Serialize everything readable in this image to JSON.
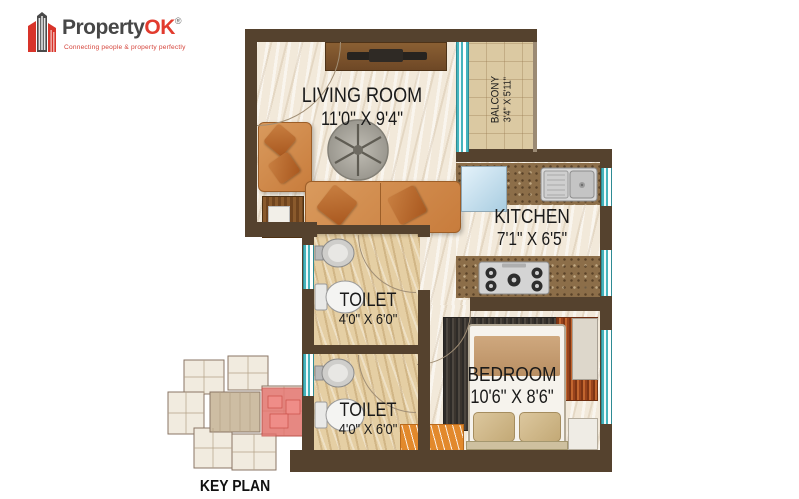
{
  "logo": {
    "brand": "Property",
    "brand_accent": "OK",
    "registered": "®",
    "tagline": "Connecting people & property perfectly"
  },
  "plan": {
    "living_room": {
      "name": "LIVING ROOM",
      "dims": "11'0\" X 9'4\""
    },
    "balcony": {
      "name": "BALCONY",
      "dims": "3'4\" X 5'11\""
    },
    "kitchen": {
      "name": "KITCHEN",
      "dims": "7'1\" X 6'5\""
    },
    "toilet_top": {
      "name": "TOILET",
      "dims": "4'0\" X 6'0\""
    },
    "toilet_bottom": {
      "name": "TOILET",
      "dims": "4'0\" X 6'0\""
    },
    "bedroom": {
      "name": "BEDROOM",
      "dims": "10'6\" X 8'6\""
    }
  },
  "key_plan": {
    "label": "KEY PLAN"
  },
  "icons": {
    "logo_icon": "buildings-icon",
    "fan_table": "round-table-icon",
    "stove": "gas-stove-icon",
    "sink": "kitchen-sink-icon",
    "wc": "toilet-icon",
    "basin": "wash-basin-icon"
  },
  "colors": {
    "brand_red": "#e23b2e",
    "brand_gray": "#474747",
    "wall_brown": "#55422e",
    "window_teal": "#45b4bd",
    "floor_cream": "#f2e9da",
    "toilet_floor": "#e5cfa4",
    "counter_brown": "#8c6e49",
    "sofa_tan": "#d99a5d",
    "keyplan_highlight": "#e4706b"
  }
}
